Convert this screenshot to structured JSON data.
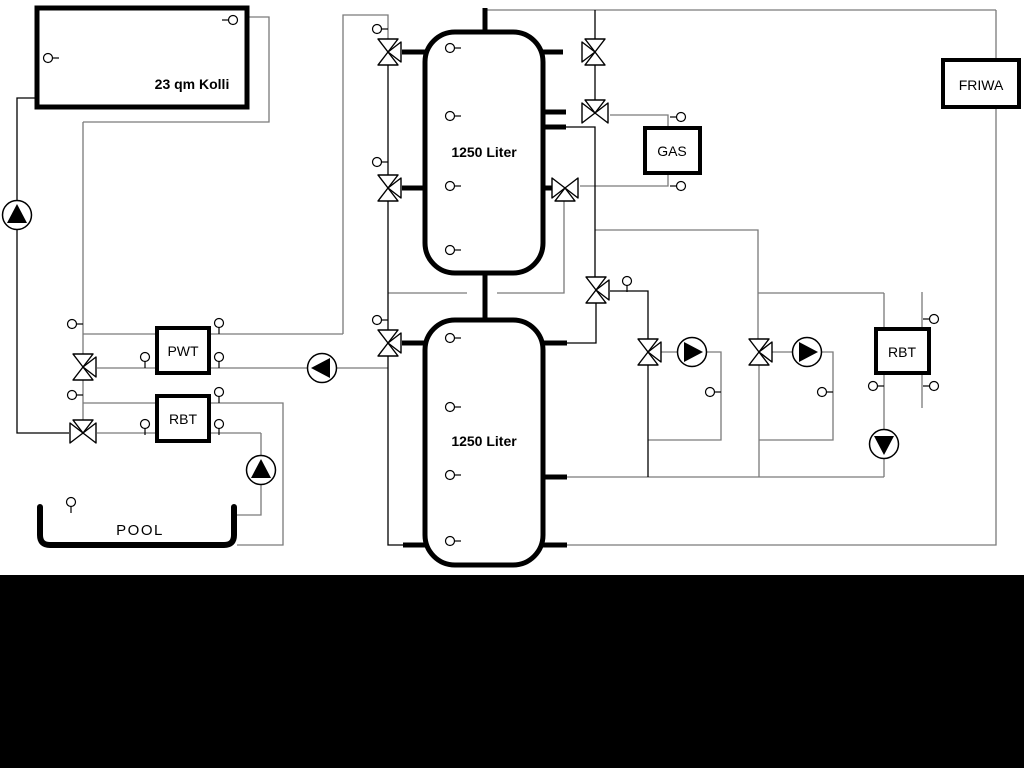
{
  "window": {
    "background": "#ffffff",
    "footer_bar_color": "#000000",
    "line_color": "#7a7a7a",
    "dark_color": "#000000"
  },
  "labels": {
    "collector": "23 qm Kolli",
    "tank_top": "1250 Liter",
    "tank_bottom": "1250 Liter",
    "heat_exchanger_pwt": "PWT",
    "heat_exchanger_rbt_pool": "RBT",
    "heat_exchanger_rbt_right": "RBT",
    "boiler_gas": "GAS",
    "fresh_water_station": "FRIWA",
    "pool": "POOL"
  },
  "icons": {
    "pump-icon": "circle with solid black triangle showing flow direction",
    "three-way-valve-icon": "double-triangle bowtie with third white triangle port",
    "temp-sensor-icon": "small circle with short stem"
  },
  "counts": {
    "storage_tanks": 2,
    "pumps": 6,
    "three_way_valves": 11,
    "temp_sensors": 30
  }
}
